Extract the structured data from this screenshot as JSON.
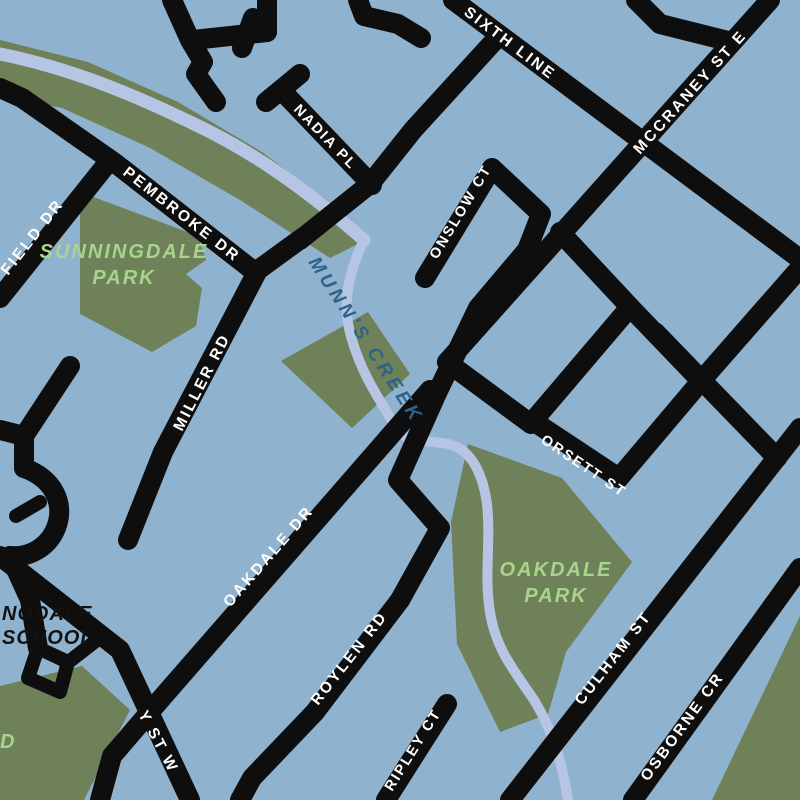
{
  "map": {
    "title": "neighbourhood-street-map",
    "colors": {
      "background": "#8FB2CE",
      "park_green": "#6F8159",
      "creek_blue": "#B5C5E3",
      "road_black": "#0E0E0E",
      "road_label_white": "#FFFFFF",
      "park_label_green": "#A9D48B",
      "creek_label_blue": "#2E6388",
      "school_label_black": "#121212"
    },
    "labels": {
      "roads": {
        "sixth_line": "SIXTH LINE",
        "mccraney_st_e": "MCCRANEY ST E",
        "nadia_pl": "NADIA PL",
        "pembroke_dr": "PEMBROKE DR",
        "field_dr": "FIELD DR",
        "miller_rd": "MILLER RD",
        "onslow_ct": "ONSLOW CT",
        "orsett_st": "ORSETT ST",
        "oakdale_dr": "OAKDALE DR",
        "roylen_rd": "ROYLEN RD",
        "ripley_ct": "RIPLEY CT",
        "culham_st": "CULHAM ST",
        "osborne_cr": "OSBORNE CR",
        "mccraney_st_w_partial": "Y ST W"
      },
      "parks": {
        "sunningdale_line1": "SUNNINGDALE",
        "sunningdale_line2": "PARK",
        "oakdale_line1": "OAKDALE",
        "oakdale_line2": "PARK",
        "partial_park_label": "D"
      },
      "school": {
        "line1": "NGDALE",
        "line2": "SCHOOL"
      },
      "creek": {
        "munns_creek": "MUNN'S CREEK"
      }
    }
  }
}
